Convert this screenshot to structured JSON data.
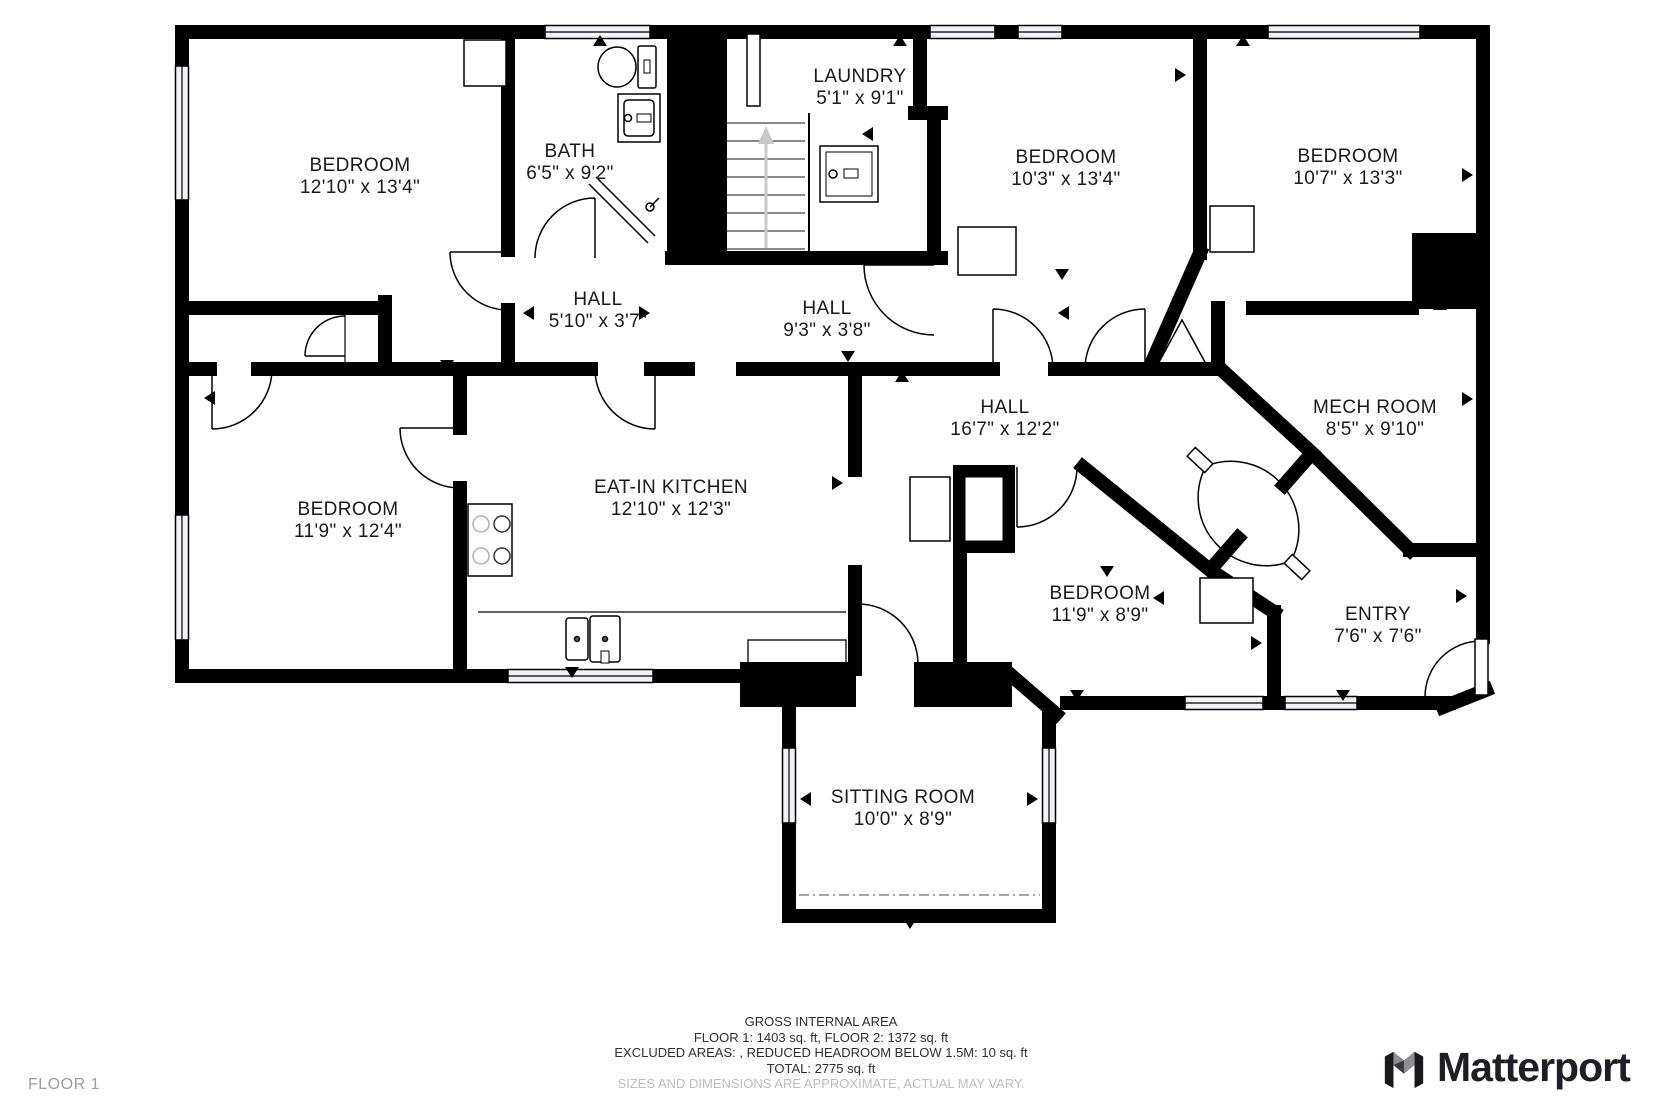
{
  "plan": {
    "rooms": [
      {
        "name": "BEDROOM",
        "dims": "12'10\" x 13'4\""
      },
      {
        "name": "BATH",
        "dims": "6'5\" x 9'2\""
      },
      {
        "name": "LAUNDRY",
        "dims": "5'1\" x 9'1\""
      },
      {
        "name": "BEDROOM",
        "dims": "10'3\" x 13'4\""
      },
      {
        "name": "BEDROOM",
        "dims": "10'7\" x 13'3\""
      },
      {
        "name": "HALL",
        "dims": "5'10\" x 3'7\""
      },
      {
        "name": "HALL",
        "dims": "9'3\" x 3'8\""
      },
      {
        "name": "HALL",
        "dims": "16'7\" x 12'2\""
      },
      {
        "name": "MECH ROOM",
        "dims": "8'5\" x 9'10\""
      },
      {
        "name": "BEDROOM",
        "dims": "11'9\" x 12'4\""
      },
      {
        "name": "EAT-IN KITCHEN",
        "dims": "12'10\" x 12'3\""
      },
      {
        "name": "BEDROOM",
        "dims": "11'9\" x 8'9\""
      },
      {
        "name": "ENTRY",
        "dims": "7'6\" x 7'6\""
      },
      {
        "name": "SITTING ROOM",
        "dims": "10'0\" x 8'9\""
      }
    ],
    "fixtures": [
      "toilet",
      "bathroom-sink",
      "shower",
      "washer",
      "stove",
      "kitchen-sink",
      "dishwasher",
      "stairs-up",
      "closet"
    ]
  },
  "footer": {
    "line1": "GROSS INTERNAL AREA",
    "line2": "FLOOR 1: 1403 sq. ft, FLOOR 2: 1372 sq. ft",
    "line3": "EXCLUDED AREAS: , REDUCED HEADROOM BELOW 1.5M: 10 sq. ft",
    "line4": "TOTAL: 2775 sq. ft",
    "disclaimer": "SIZES AND DIMENSIONS ARE APPROXIMATE, ACTUAL MAY VARY."
  },
  "floor_label": "FLOOR 1",
  "brand": {
    "name": "Matterport"
  },
  "colors": {
    "wall": "#000000",
    "window_fill": "#f2f1f7",
    "stair_arrow": "#c8c8c8",
    "text": "#1a1a1a",
    "muted": "#bdbdbd",
    "floor_label": "#9c9c9c",
    "brand_text": "#1e1e24",
    "brand_gray": "#8e8e94"
  }
}
